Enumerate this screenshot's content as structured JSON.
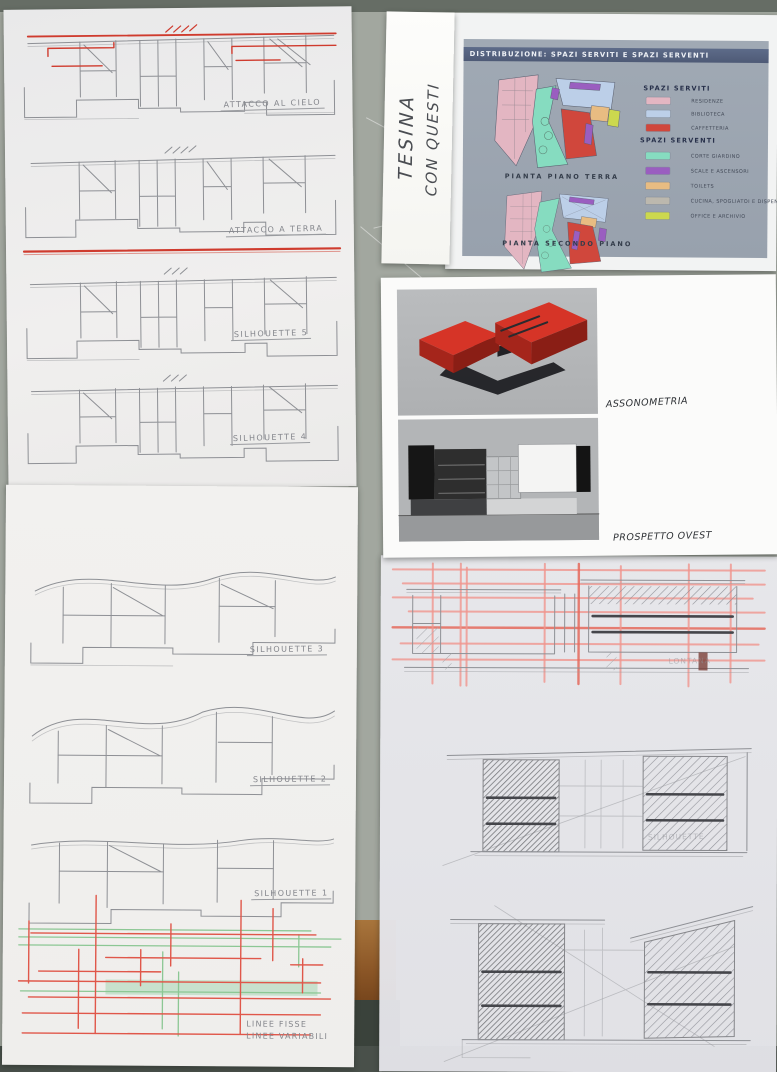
{
  "board": {
    "title": "DISTRIBUZIONE: SPAZI SERVITI E SPAZI SERVENTI",
    "plan_ground_caption": "PIANTA PIANO TERRA",
    "plan_second_caption": "PIANTA SECONDO PIANO",
    "legend_served_title": "SPAZI SERVITI",
    "legend_served": [
      {
        "label": "RESIDENZE",
        "color": "#e3b6c2"
      },
      {
        "label": "BIBLIOTECA",
        "color": "#bccfe8"
      },
      {
        "label": "CAFFETTERIA",
        "color": "#d0473c"
      }
    ],
    "legend_serving_title": "SPAZI SERVENTI",
    "legend_serving": [
      {
        "label": "CORTE GIARDINO",
        "color": "#86dcc0"
      },
      {
        "label": "SCALE E ASCENSORI",
        "color": "#9a5ec0"
      },
      {
        "label": "TOILETS",
        "color": "#e8bc82"
      },
      {
        "label": "CUCINA, SPOGLIATOI E DISPENSA",
        "color": "#bcb8ae"
      },
      {
        "label": "OFFICE E ARCHIVIO",
        "color": "#ccd84e"
      }
    ]
  },
  "sticky_note": {
    "line1": "TESINA",
    "line2": "CON QUESTI"
  },
  "sheet_top_left": {
    "sketches": [
      {
        "label": "ATTACCO AL CIELO"
      },
      {
        "label": "ATTACCO A TERRA"
      },
      {
        "label": "SILHOUETTE 5"
      },
      {
        "label": "SILHOUETTE 4"
      }
    ]
  },
  "sheet_bottom_left": {
    "sketches": [
      {
        "label": "SILHOUETTE 3"
      },
      {
        "label": "SILHOUETTE 2"
      },
      {
        "label": "SILHOUETTE 1"
      }
    ],
    "diagram_label": {
      "line1": "LINEE FISSE",
      "line2": "LINEE VARIABILI"
    }
  },
  "render_sheet": {
    "axon_label": "ASSONOMETRIA",
    "elevation_label": "PROSPETTO OVEST"
  },
  "tracing_sheet": {
    "labels": [
      {
        "label": "LONTANA"
      },
      {
        "label": "SILHOUETTE"
      }
    ]
  },
  "colors": {
    "red_pen": "#cf3b2e",
    "red_grid": "#f0958d",
    "green_line": "#8cc794",
    "board_panel": "#9aa3b0",
    "board_header": "#55617d",
    "model_red": "#d63427",
    "wood_edge": "#9c6530"
  }
}
